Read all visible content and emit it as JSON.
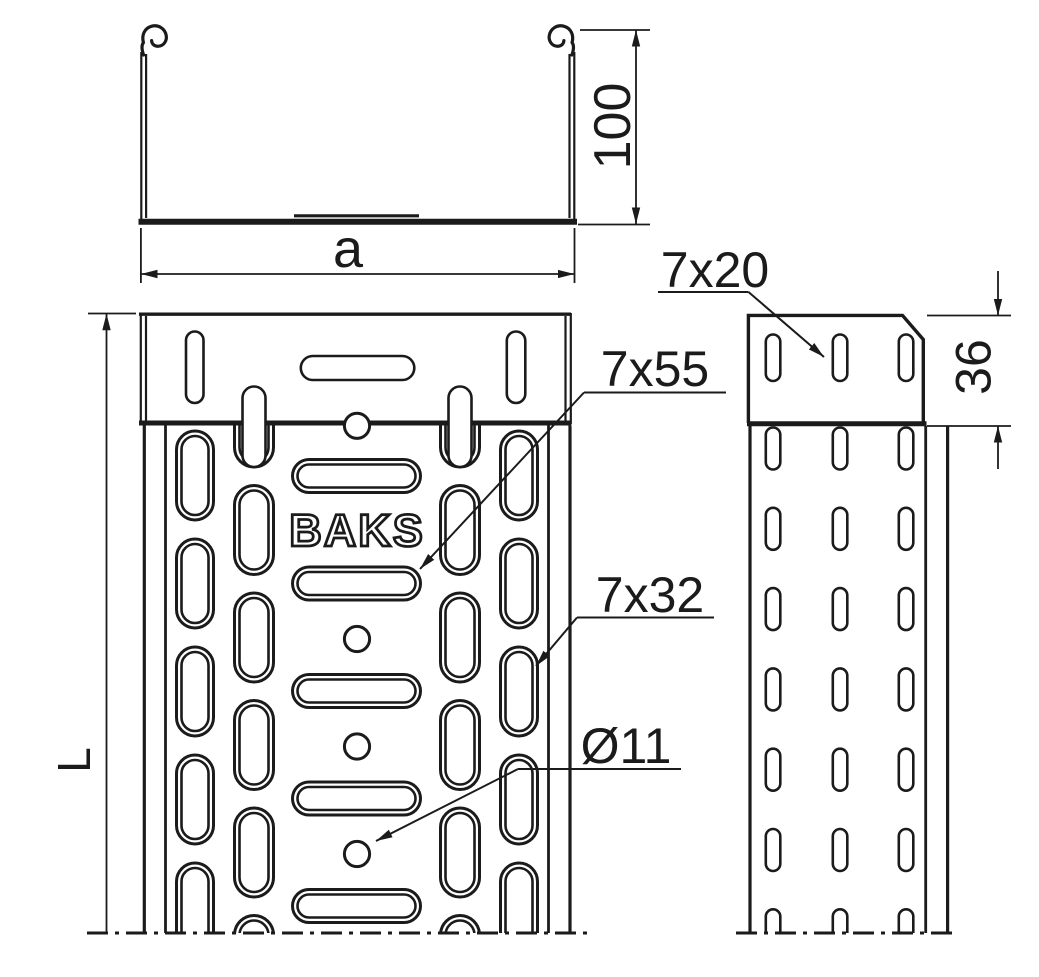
{
  "drawing": {
    "brand_label": "BAKS",
    "dimensions": {
      "width": "a",
      "height": "100",
      "length": "L",
      "connector_height": "36"
    },
    "perforation_labels": {
      "center_slot": "7x55",
      "flange_slot": "7x32",
      "hole_diameter": "Ø11",
      "side_slot": "7x20"
    }
  },
  "colors": {
    "line": "#1b1b1b",
    "background": "#ffffff"
  }
}
